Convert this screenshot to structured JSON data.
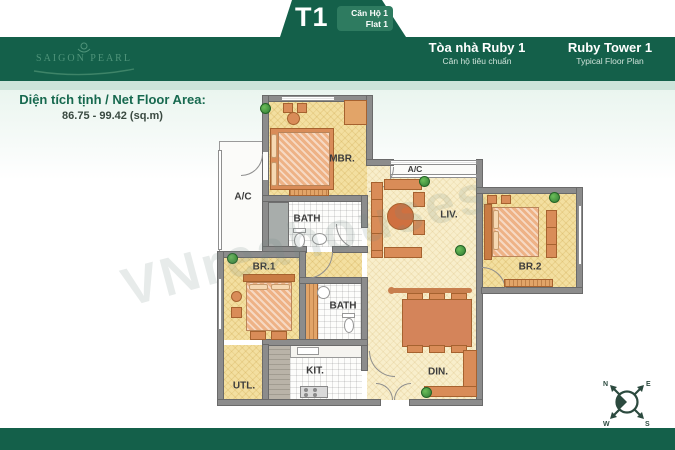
{
  "header": {
    "tab": {
      "code": "T1",
      "unit_vi": "Căn Hộ 1",
      "unit_en": "Flat 1"
    },
    "logo_text": "SAIGON PEARL",
    "building_vi": {
      "title": "Tòa nhà Ruby 1",
      "subtitle": "Căn hộ tiêu chuẩn"
    },
    "building_en": {
      "title": "Ruby Tower 1",
      "subtitle": "Typical Floor Plan"
    }
  },
  "area": {
    "label": "Diện tích tịnh / Net Floor Area:",
    "value": "86.75 - 99.42 (sq.m)"
  },
  "plan": {
    "rooms": [
      {
        "label": "MBR."
      },
      {
        "label": "A/C"
      },
      {
        "label": "BATH"
      },
      {
        "label": "A/C"
      },
      {
        "label": "LIV."
      },
      {
        "label": "BR.2"
      },
      {
        "label": "BR.1"
      },
      {
        "label": "BATH"
      },
      {
        "label": "KIT."
      },
      {
        "label": "UTL."
      },
      {
        "label": "DIN."
      }
    ],
    "watermark": "VNreahouses"
  },
  "compass": {
    "n": "N",
    "e": "E",
    "s": "S",
    "w": "W"
  },
  "colors": {
    "brand_green": "#14604a",
    "pill_green": "#2e7b60",
    "mint_strip": "#cde4da",
    "floor_yellow": "#f3dfa0",
    "floor_cream": "#f8eecb",
    "wall_gray": "#8c8c8c",
    "furniture_orange": "#d98c58"
  }
}
